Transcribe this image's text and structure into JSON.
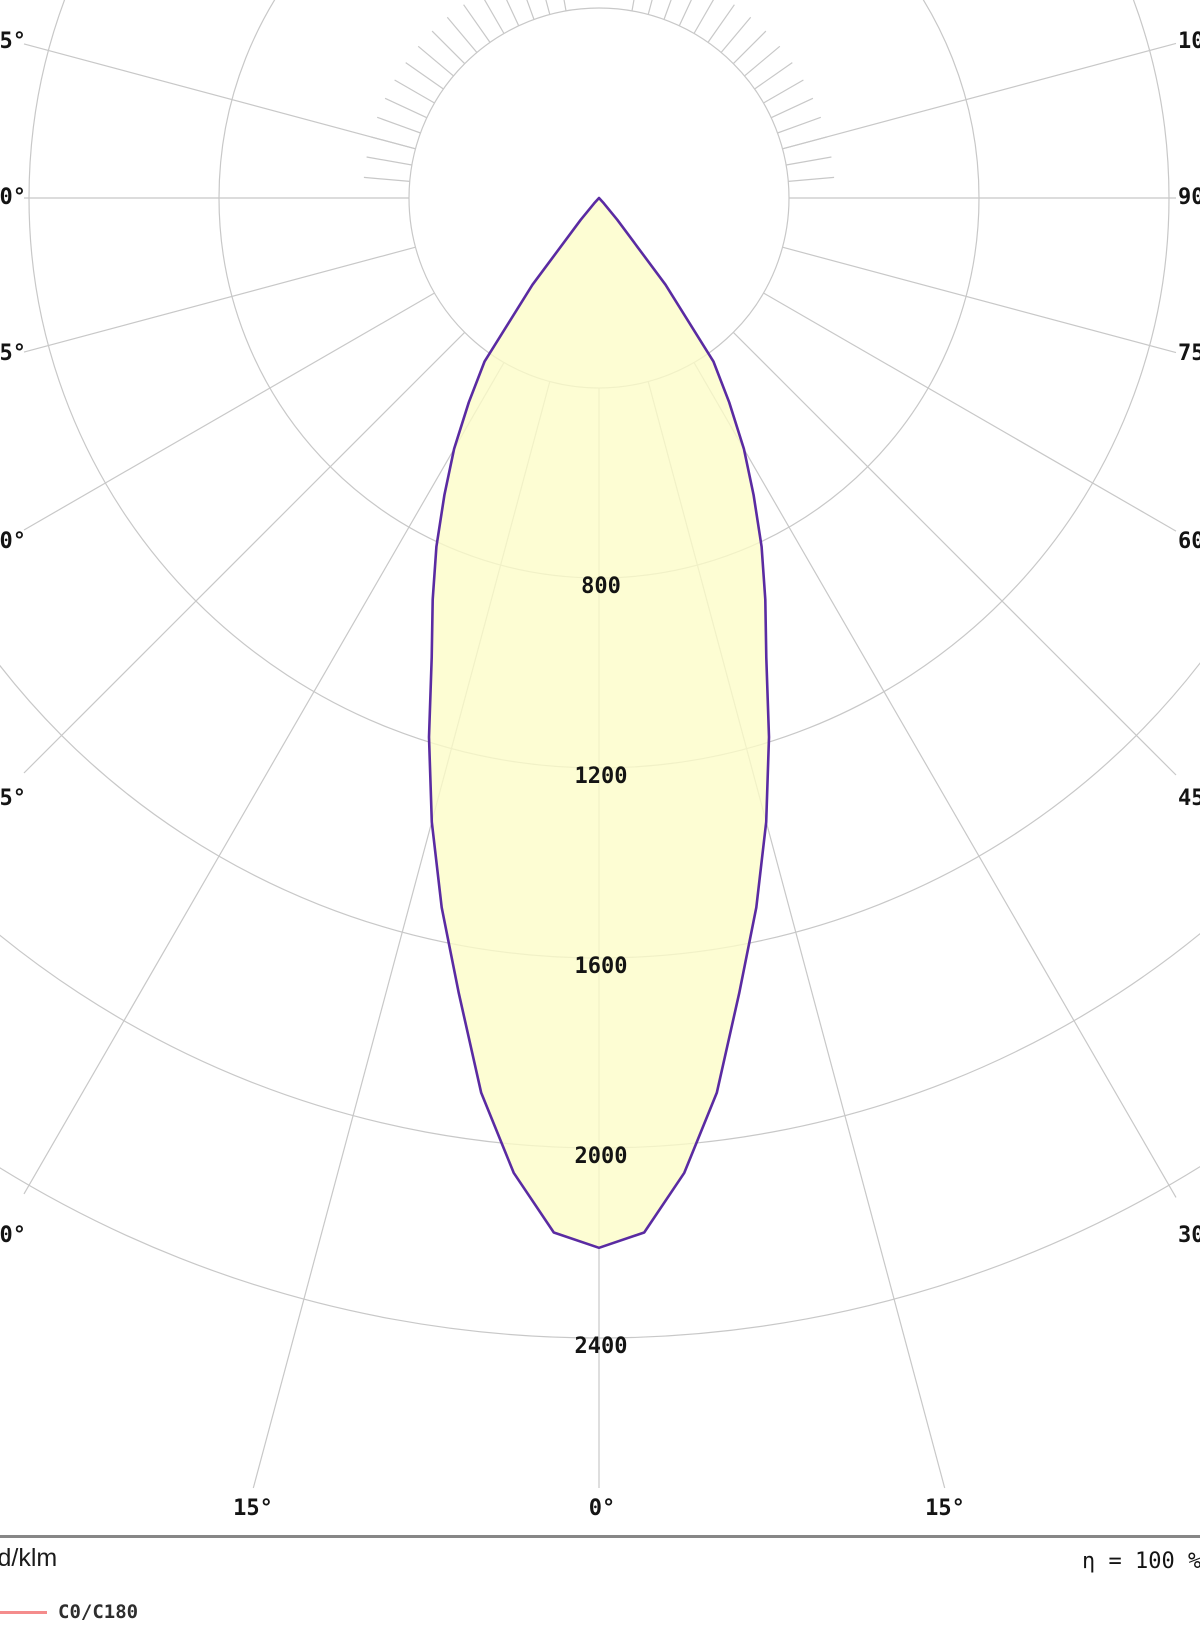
{
  "colors": {
    "background": "#ffffff",
    "grid": "#c8c8c8",
    "separator": "#878787",
    "text": "#141414",
    "curve_stroke": "#5a2ba2",
    "curve_fill": "rgba(253,253,199,0.78)",
    "legend_red": "#f48c8c"
  },
  "chart_data": {
    "type": "polar",
    "description": "Photometric luminous intensity distribution curve (polar diagram), C0/C180 plane",
    "units_label": "cd/klm",
    "efficiency_label": "η = 100 %",
    "legend": [
      {
        "label": "C0/C180",
        "color": "#f48c8c"
      }
    ],
    "radial_axis": {
      "unit": "cd/klm",
      "ring_step": 400,
      "max": 2400,
      "rings": [
        400,
        800,
        1200,
        1600,
        2000,
        2400
      ],
      "ring_labels": [
        "800",
        "1200",
        "1600",
        "2000",
        "2400"
      ]
    },
    "angular_axis": {
      "step_deg": 15,
      "left_labels": [
        "105°",
        "90°",
        "75°",
        "60°",
        "45°",
        "30°"
      ],
      "right_labels": [
        "105°",
        "90°",
        "75°",
        "60°",
        "45°",
        "30°"
      ],
      "bottom_labels": [
        "15°",
        "0°",
        "15°"
      ],
      "minor_tick_step_deg": 5
    },
    "series": [
      {
        "name": "C0/C180",
        "stroke": "#5a2ba2",
        "fill": "rgba(253,253,199,0.78)",
        "symmetric": true,
        "points_deg_intensity": [
          [
            0,
            2210
          ],
          [
            2.5,
            2180
          ],
          [
            5,
            2060
          ],
          [
            7.5,
            1900
          ],
          [
            10,
            1700
          ],
          [
            12.5,
            1530
          ],
          [
            15,
            1360
          ],
          [
            17.5,
            1190
          ],
          [
            20,
            1030
          ],
          [
            22.5,
            915
          ],
          [
            25,
            810
          ],
          [
            27.5,
            705
          ],
          [
            30,
            610
          ],
          [
            32.5,
            510
          ],
          [
            35,
            420
          ],
          [
            37.5,
            230
          ],
          [
            40,
            60
          ],
          [
            42.5,
            15
          ],
          [
            45,
            0
          ]
        ]
      }
    ]
  }
}
